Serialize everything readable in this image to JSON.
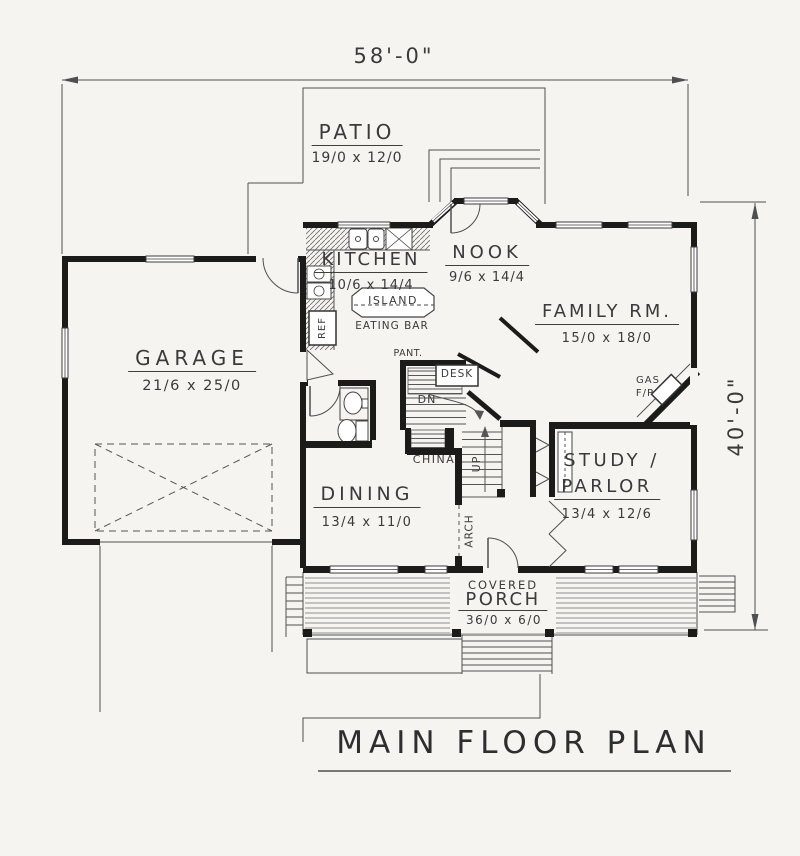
{
  "title": {
    "text": "MAIN FLOOR PLAN"
  },
  "dimensions": {
    "overall_width": "58'-0\"",
    "overall_height": "40'-0\""
  },
  "rooms": {
    "patio": {
      "name": "PATIO",
      "size": "19/0 x 12/0"
    },
    "kitchen": {
      "name": "KITCHEN",
      "size": "10/6 x 14/4"
    },
    "nook": {
      "name": "NOOK",
      "size": "9/6 x 14/4"
    },
    "family_room": {
      "name": "FAMILY RM.",
      "size": "15/0 x 18/0"
    },
    "garage": {
      "name": "GARAGE",
      "size": "21/6 x 25/0"
    },
    "dining": {
      "name": "DINING",
      "size": "13/4 x 11/0"
    },
    "study": {
      "name_line1": "STUDY /",
      "name_line2": "PARLOR",
      "size": "13/4 x 12/6"
    },
    "porch": {
      "label_top": "COVERED",
      "name": "PORCH",
      "size": "36/0 x 6/0"
    }
  },
  "features": {
    "island": "ISLAND",
    "eating_bar": "EATING BAR",
    "refrigerator": "REF",
    "pantry": "PANT.",
    "desk": "DESK",
    "stairs_down": "DN",
    "stairs_up": "UP",
    "china_cabinet": "CHINA",
    "arch": "ARCH",
    "fireplace_line1": "GAS",
    "fireplace_line2": "F/P"
  },
  "colors": {
    "paper": "#f5f4f1",
    "wall": "#1b1b1a",
    "line": "#4f4f4f",
    "ink": "#3a3a3a"
  }
}
